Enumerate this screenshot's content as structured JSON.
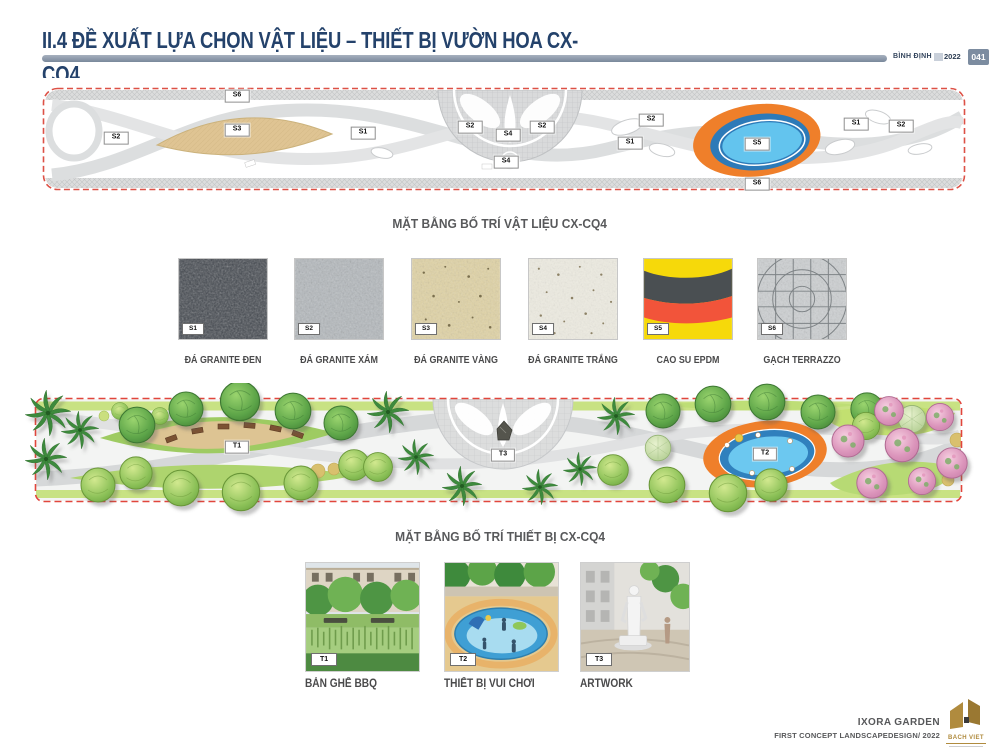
{
  "header": {
    "title_line1": "II.4 ĐỀ XUẤT LỰA CHỌN VẬT LIỆU – THIẾT BỊ VƯỜN HOA CX-",
    "title_line2": "CQ4",
    "location": "BÌNH ĐỊNH",
    "year": "2022",
    "page_number": "041"
  },
  "materials_plan": {
    "caption": "MẶT BẰNG BỐ TRÍ VẬT LIỆU CX-CQ4",
    "labels": [
      {
        "code": "S6",
        "x": 195,
        "y": 9
      },
      {
        "code": "S2",
        "x": 74,
        "y": 51
      },
      {
        "code": "S3",
        "x": 195,
        "y": 43
      },
      {
        "code": "S1",
        "x": 321,
        "y": 46
      },
      {
        "code": "S2",
        "x": 428,
        "y": 40
      },
      {
        "code": "S4",
        "x": 466,
        "y": 48
      },
      {
        "code": "S2",
        "x": 500,
        "y": 40
      },
      {
        "code": "S4",
        "x": 464,
        "y": 75
      },
      {
        "code": "S2",
        "x": 609,
        "y": 33
      },
      {
        "code": "S1",
        "x": 588,
        "y": 56
      },
      {
        "code": "S5",
        "x": 715,
        "y": 57
      },
      {
        "code": "S1",
        "x": 814,
        "y": 37
      },
      {
        "code": "S2",
        "x": 859,
        "y": 39
      },
      {
        "code": "S6",
        "x": 715,
        "y": 97
      }
    ]
  },
  "materials": [
    {
      "code": "S1",
      "name": "ĐÁ GRANITE ĐEN"
    },
    {
      "code": "S2",
      "name": "ĐÁ GRANITE XÁM"
    },
    {
      "code": "S3",
      "name": "ĐÁ GRANITE VÀNG"
    },
    {
      "code": "S4",
      "name": "ĐÁ GRANITE TRẮNG"
    },
    {
      "code": "S5",
      "name": "CAO SU EPDM"
    },
    {
      "code": "S6",
      "name": "GẠCH TERRAZZO"
    }
  ],
  "equipment_plan": {
    "caption": "MẶT BẰNG BỐ TRÍ THIẾT BỊ CX-CQ4",
    "labels": [
      {
        "code": "T1",
        "x": 237,
        "y": 64
      },
      {
        "code": "T3",
        "x": 503,
        "y": 72
      },
      {
        "code": "T2",
        "x": 765,
        "y": 71
      }
    ]
  },
  "equipment": [
    {
      "code": "T1",
      "name": "BÀN GHẾ BBQ"
    },
    {
      "code": "T2",
      "name": "THIẾT BỊ VUI CHƠI"
    },
    {
      "code": "T3",
      "name": "ARTWORK"
    }
  ],
  "footer": {
    "project": "IXORA GARDEN",
    "subtitle": "FIRST CONCEPT LANDSCAPEDESIGN/ 2022",
    "logo_text": "BACH VIET"
  },
  "colors": {
    "title": "#24426b",
    "accent_red": "#dd5146",
    "epdm_orange": "#ef7f2a",
    "pool_blue": "#2d7ab8",
    "pool_light_blue": "#63c4ee",
    "caption_gray": "#58595b",
    "logo_gold": "#b08b3e"
  }
}
